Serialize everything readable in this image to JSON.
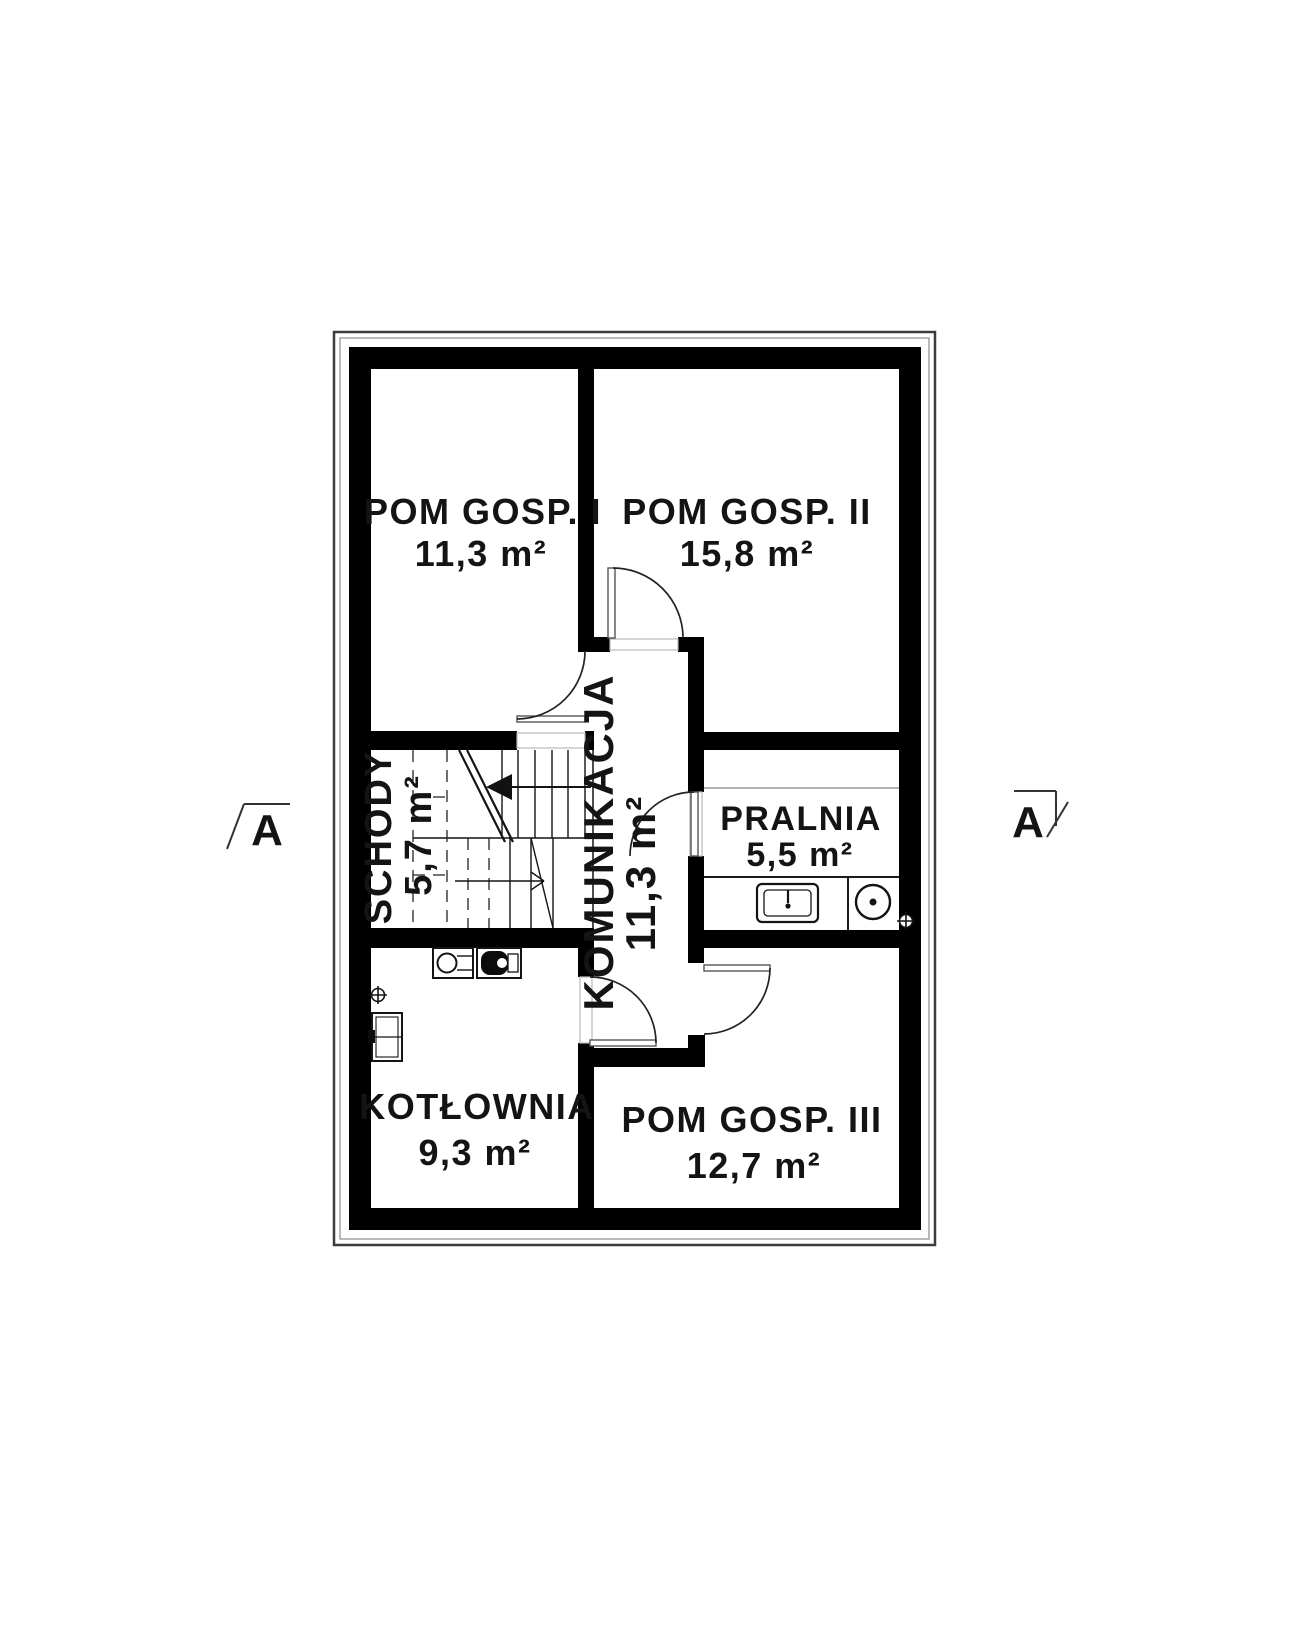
{
  "rooms": {
    "pom_gosp_1": {
      "name": "POM GOSP. I",
      "area": "11,3 m²"
    },
    "pom_gosp_2": {
      "name": "POM GOSP. II",
      "area": "15,8 m²"
    },
    "schody": {
      "name": "SCHODY",
      "area": "5,7 m²"
    },
    "komunikacja": {
      "name": "KOMUNIKACJA",
      "area": "11,3 m²"
    },
    "pralnia": {
      "name": "PRALNIA",
      "area": "5,5 m²"
    },
    "kotlownia": {
      "name": "KOTŁOWNIA",
      "area": "9,3 m²"
    },
    "pom_gosp_3": {
      "name": "POM GOSP. III",
      "area": "12,7 m²"
    }
  },
  "section_markers": {
    "left": "A",
    "right": "A"
  },
  "colors": {
    "wall": "#000000",
    "background": "#ffffff",
    "line": "#222222",
    "light_line": "#999999"
  }
}
